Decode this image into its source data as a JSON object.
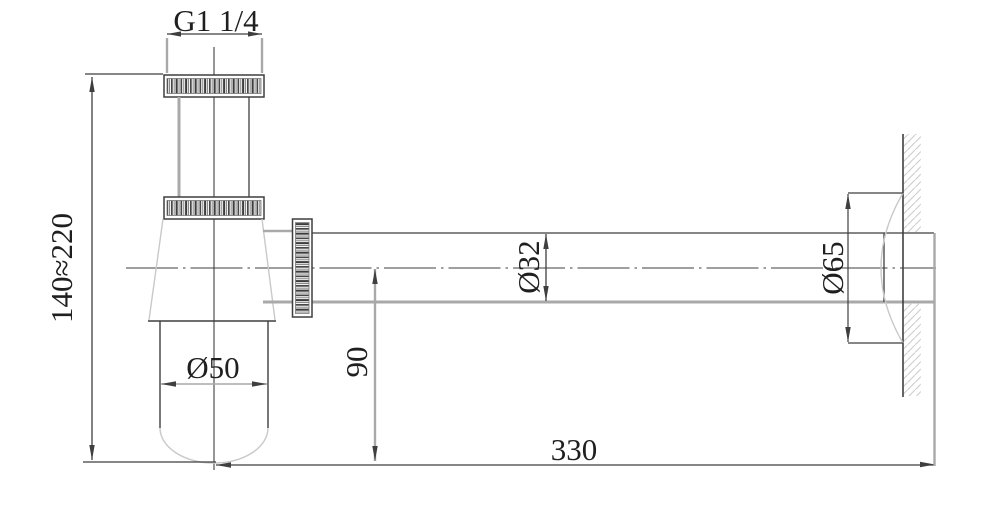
{
  "drawing": {
    "type": "technical-dimension-drawing",
    "subject": "wall-mounted bottle trap siphon, side view",
    "dimensions": {
      "thread": "G1 1/4",
      "height_range": "140≈220",
      "cup_diameter": "Ø50",
      "pipe_diameter": "Ø32",
      "drop_height": "90",
      "flange_diameter": "Ø65",
      "length": "330"
    }
  },
  "colors": {
    "bg": "#ffffff",
    "line_dark": "#3f3f3f",
    "line_gray": "#a9a9a9",
    "line_light": "#c9c9c9",
    "text_color": "#1f1f1f"
  }
}
